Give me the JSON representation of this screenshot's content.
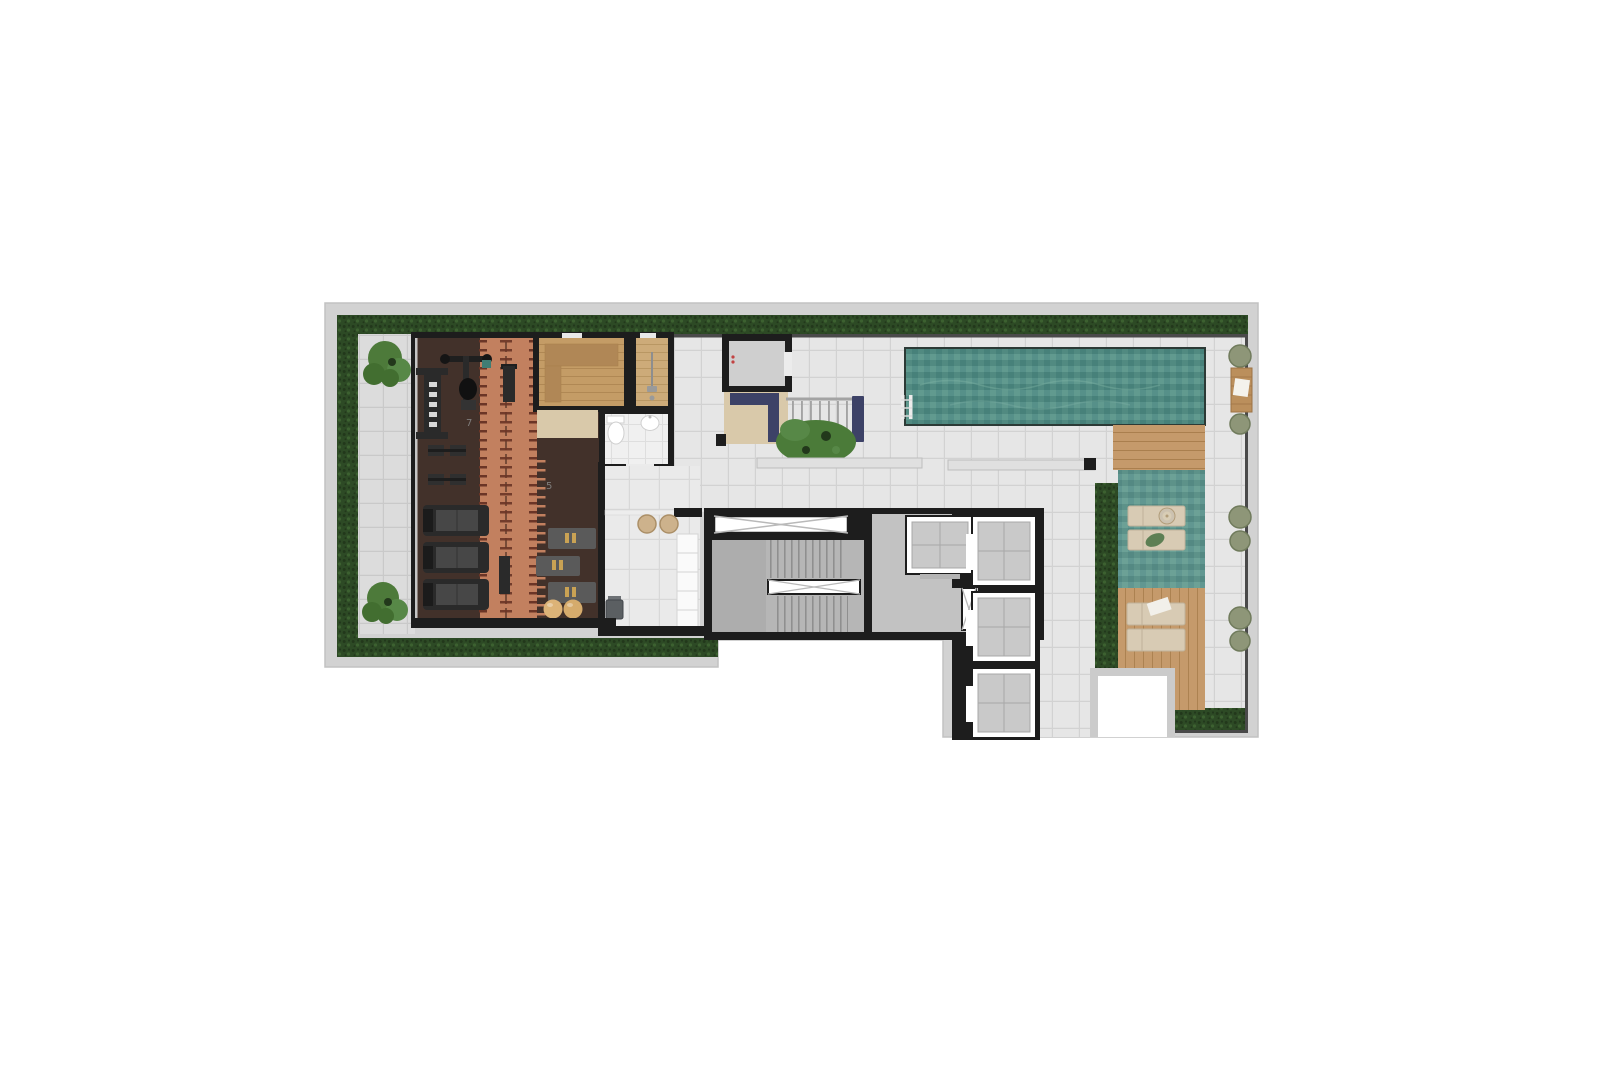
{
  "plan": {
    "type": "rooftop-amenities-floor-plan",
    "track_markers": {
      "upper": "7",
      "lower": "5"
    },
    "zones": [
      {
        "name": "perimeter-hedge"
      },
      {
        "name": "side-walkway"
      },
      {
        "name": "gym"
      },
      {
        "name": "running-track"
      },
      {
        "name": "sauna"
      },
      {
        "name": "shower-room"
      },
      {
        "name": "bathroom"
      },
      {
        "name": "pantry"
      },
      {
        "name": "stair-hall"
      },
      {
        "name": "elevator-lobby"
      },
      {
        "name": "elevator-bank"
      },
      {
        "name": "lap-pool"
      },
      {
        "name": "pool-deck"
      },
      {
        "name": "wet-deck-lounge"
      },
      {
        "name": "wood-sun-deck"
      },
      {
        "name": "planter-strip"
      },
      {
        "name": "roof-void"
      }
    ],
    "counts": {
      "treadmills": 3,
      "strength_stations": 4,
      "exercise_mats": 3,
      "exercise_balls": 2,
      "elevators": 4,
      "stair_flights": 2,
      "pool_ladders": 1,
      "sun_loungers": 4,
      "round_planters": 6,
      "wood_benches": 1,
      "stools": 2,
      "toilets": 1,
      "sinks": 1,
      "showers": 2,
      "trees": 2,
      "navy_benches": 3
    }
  },
  "palette": {
    "background": "#ffffff",
    "rim": "#d2d2d2",
    "rim_edge": "#c2c2c2",
    "wall": "#1d1d1d",
    "wall_light": "#4a4a4a",
    "hedge": "#2d4a25",
    "hedge_dark": "#22381b",
    "hedge_light": "#3c6130",
    "walkway_tile": "#dcdcdc",
    "walkway_line": "#c9c9c9",
    "deck_tile": "#e6e6e6",
    "deck_line": "#d2d2d2",
    "corridor_tile": "#eaeaea",
    "corridor_line": "#d8d8d8",
    "bath_tile": "#f0f0f0",
    "bath_line": "#dedede",
    "gym_floor": "#42312a",
    "track": "#c2805f",
    "track_tick": "#6b3526",
    "track_center": "#5f3a2b",
    "sauna_wood": "#c49c66",
    "sauna_line": "#a9814e",
    "sauna_bench": "#b08756",
    "shower_wood": "#cdab79",
    "shower_line": "#b3905c",
    "porcelain": "#ffffff",
    "fixture_line": "#cfcfcf",
    "beige_floor": "#d9c9aa",
    "navy": "#3d4267",
    "railing": "#a3a3a3",
    "stair_floor": "#b6b6b6",
    "stair_shade": "#adadad",
    "step_line": "#8f8f8f",
    "lobby": "#c2c2c2",
    "elevator_car": "#c9c9c9",
    "elevator_line": "#a8a8a8",
    "hatch_line": "#b9b9b9",
    "pool_a": "#569089",
    "pool_b": "#47817a",
    "pool_c": "#619a8f",
    "pool_d": "#518a81",
    "pool_edge": "#2c3a36",
    "wave": "#7fb3a6",
    "wood": "#c59a6b",
    "wood_line": "#aa7f4e",
    "lounger": "#d8cbb4",
    "lounger_line": "#bfb29a",
    "table_top": "#ccc2b0",
    "planter": "#8e9678",
    "planter_edge": "#707b5c",
    "tree_a": "#4d7a3a",
    "tree_b": "#578847",
    "tree_c": "#426e30",
    "shrub": "#4b7b39",
    "gold": "#c9a254",
    "ball": "#dcb377",
    "ball2": "#d5ab6c",
    "equip_dark": "#2a2a2a",
    "equip_mid": "#474747",
    "mat": "#5a5a5a",
    "counter": "#fafafa",
    "counter_line": "#d4d4d4",
    "stool": "#cdb28c",
    "stool_edge": "#ab8f67",
    "bin": "#5b5f62",
    "ledge": "#e0e0e0",
    "ledge_edge": "#bdbdbd",
    "void_border": "#cbcbcb",
    "marker": "#8a8a8a"
  }
}
